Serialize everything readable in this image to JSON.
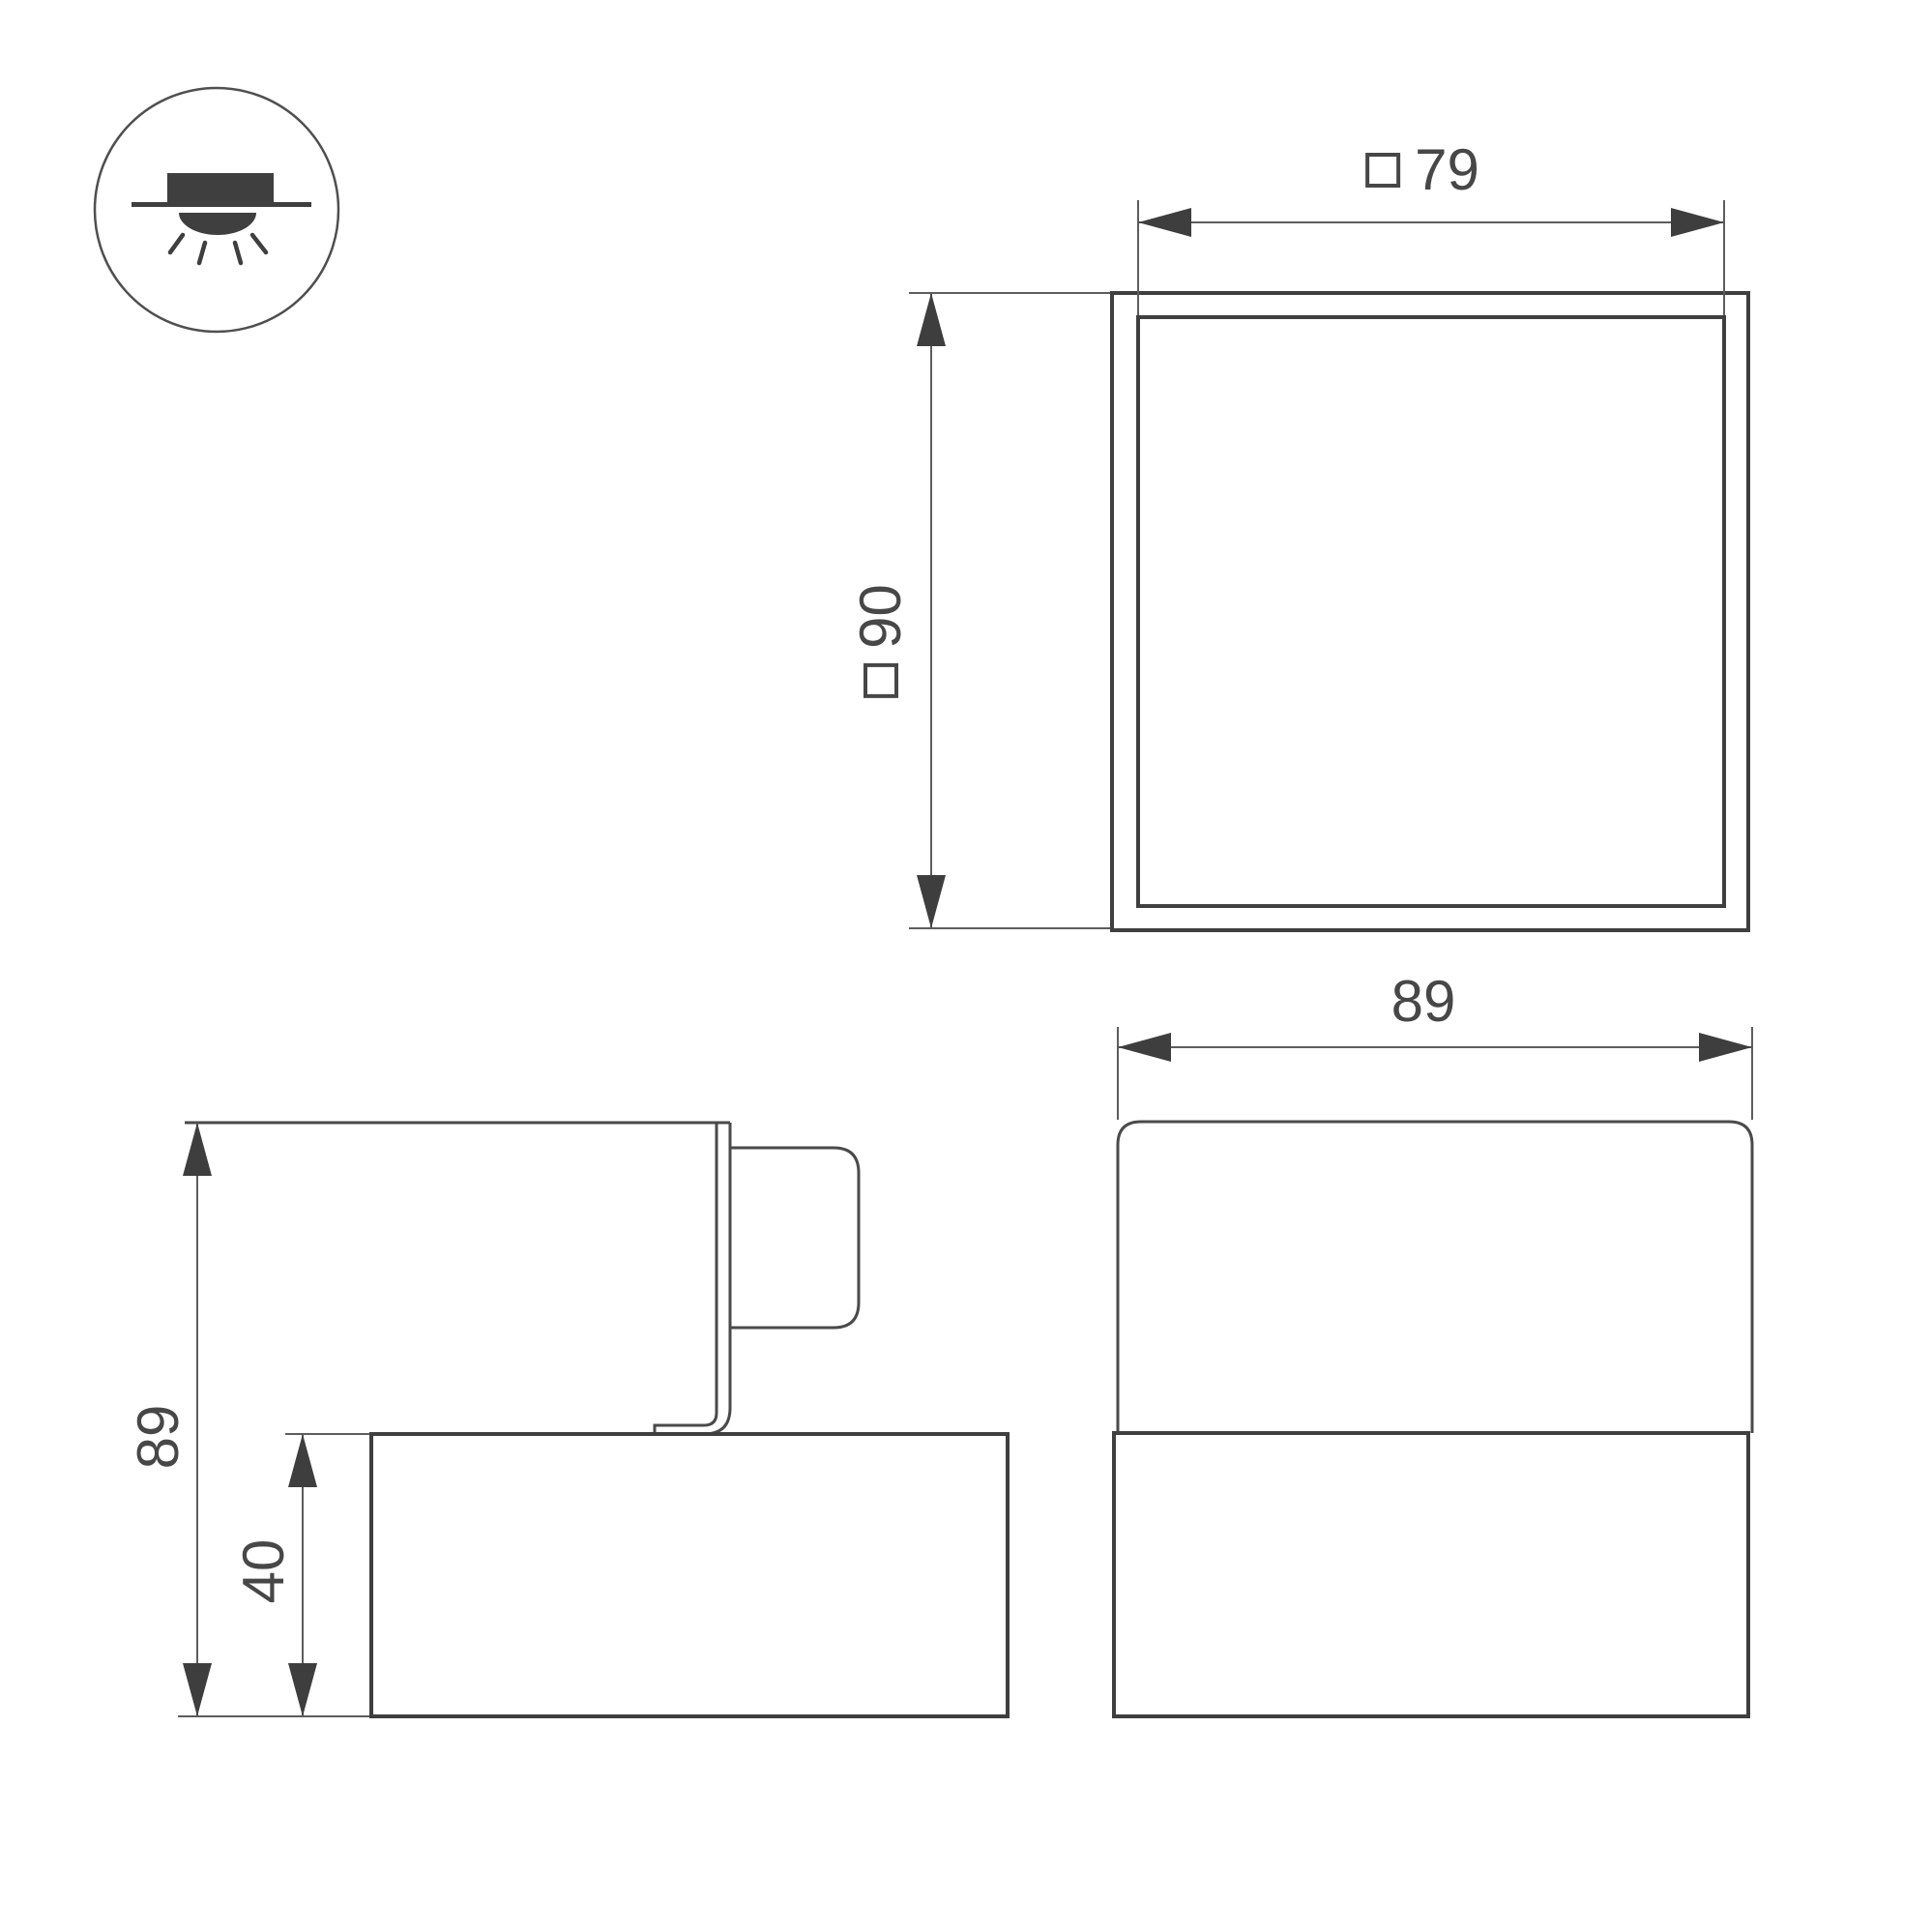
{
  "page": {
    "background": "#ffffff"
  },
  "legend_icon": {
    "name": "surface-downlight-mount-icon"
  },
  "views": {
    "top": {
      "width_dim": {
        "prefix_symbol": "□",
        "value": "79"
      },
      "size_dim": {
        "prefix_symbol": "□",
        "value": "90"
      }
    },
    "side": {
      "height_dim": {
        "value": "89"
      },
      "base_height_dim": {
        "value": "40"
      }
    },
    "front": {
      "width_dim": {
        "value": "89"
      }
    }
  },
  "style": {
    "object_line_color": "#3f3f3f",
    "dimension_line_color": "#5d5d5d",
    "text_color": "#474747"
  }
}
